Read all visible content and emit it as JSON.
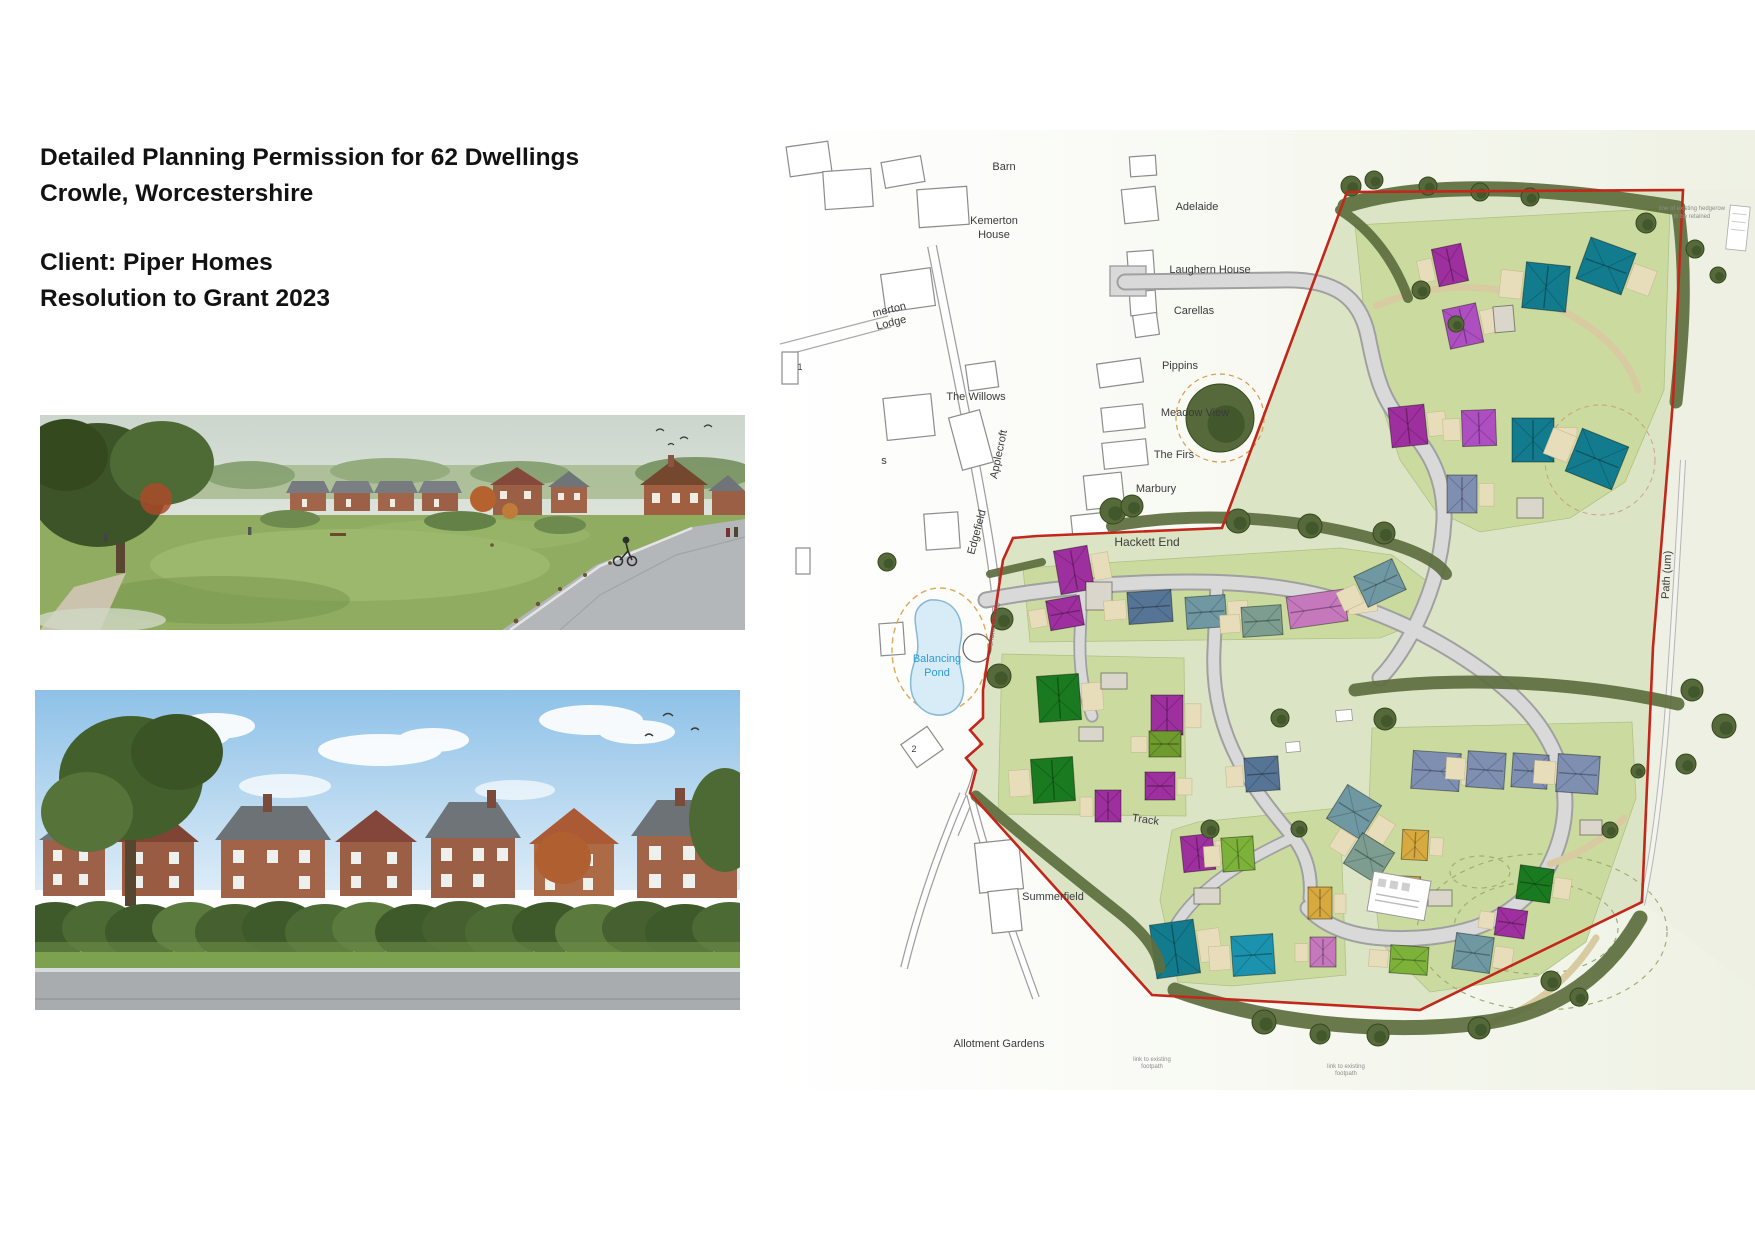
{
  "header": {
    "line1": "Detailed Planning Permission for 62 Dwellings",
    "line2": "Crowle, Worcestershire",
    "line3": "Client: Piper Homes",
    "line4": "Resolution to Grant 2023"
  },
  "map": {
    "boundary_color": "#c2271b",
    "pond_text_color": "#2e9bd6",
    "palette": {
      "magenta": "#9e2f9e",
      "violet": "#ad4fc0",
      "pink": "#c678bd",
      "teal": "#127c8e",
      "cyan": "#1b93ae",
      "steel": "#7e8fb2",
      "bluegrey": "#567495",
      "tealgrey": "#6f98a3",
      "sage": "#7d9d90",
      "green": "#1a7a1f",
      "lime": "#7cb23a",
      "olive": "#6f9a2e",
      "yellow": "#d8a93e",
      "garage": "#dad6cc"
    },
    "labels": [
      {
        "t": "Barn",
        "x": 224,
        "y": 40
      },
      {
        "t": "Kemerton",
        "x": 214,
        "y": 94
      },
      {
        "t": "House",
        "x": 214,
        "y": 108
      },
      {
        "t": "merton",
        "x": 110,
        "y": 183,
        "r": -14
      },
      {
        "t": "Lodge",
        "x": 112,
        "y": 196,
        "r": -14
      },
      {
        "t": "Adelaide",
        "x": 417,
        "y": 80
      },
      {
        "t": "Laughern House",
        "x": 430,
        "y": 143
      },
      {
        "t": "Carellas",
        "x": 414,
        "y": 184
      },
      {
        "t": "Pippins",
        "x": 400,
        "y": 239
      },
      {
        "t": "Meadow View",
        "x": 415,
        "y": 286
      },
      {
        "t": "The Firs",
        "x": 394,
        "y": 328
      },
      {
        "t": "Marbury",
        "x": 376,
        "y": 362
      },
      {
        "t": "The Willows",
        "x": 196,
        "y": 270
      },
      {
        "t": "Applecroft",
        "x": 222,
        "y": 325,
        "r": -78
      },
      {
        "t": "Edgefield",
        "x": 200,
        "y": 403,
        "r": -75
      },
      {
        "t": "s",
        "x": 104,
        "y": 334
      },
      {
        "t": "Hackett End",
        "x": 367,
        "y": 416,
        "s": 12
      },
      {
        "t": "Balancing",
        "x": 157,
        "y": 532,
        "c": "#2e9bd6"
      },
      {
        "t": "Pond",
        "x": 157,
        "y": 546,
        "c": "#2e9bd6"
      },
      {
        "t": "Summerfield",
        "x": 273,
        "y": 770
      },
      {
        "t": "Allotment Gardens",
        "x": 219,
        "y": 917
      },
      {
        "t": "Track",
        "x": 365,
        "y": 693,
        "r": 8
      },
      {
        "t": "Path (um)",
        "x": 890,
        "y": 445,
        "r": -87
      },
      {
        "t": "CHURCH ROAD",
        "x": 216,
        "y": 495,
        "r": -80,
        "s": 6,
        "c": "#666666"
      },
      {
        "t": "2",
        "x": 134,
        "y": 622,
        "s": 9
      },
      {
        "t": "1",
        "x": 20,
        "y": 240,
        "s": 9
      },
      {
        "t": "line of existing hedgerow",
        "x": 912,
        "y": 80,
        "s": 6,
        "c": "#8d8d8d"
      },
      {
        "t": "to be retained",
        "x": 912,
        "y": 88,
        "s": 6,
        "c": "#8d8d8d"
      },
      {
        "t": "link to existing",
        "x": 372,
        "y": 931,
        "s": 6,
        "c": "#8d8d8d"
      },
      {
        "t": "footpath",
        "x": 372,
        "y": 938,
        "s": 6,
        "c": "#8d8d8d"
      },
      {
        "t": "link to existing",
        "x": 566,
        "y": 938,
        "s": 6,
        "c": "#8d8d8d"
      },
      {
        "t": "footpath",
        "x": 566,
        "y": 945,
        "s": 6,
        "c": "#8d8d8d"
      }
    ],
    "houses": [
      [
        655,
        116,
        30,
        38,
        -12,
        "magenta"
      ],
      [
        666,
        176,
        34,
        40,
        -12,
        "violet"
      ],
      [
        744,
        134,
        44,
        46,
        6,
        "teal"
      ],
      [
        802,
        114,
        48,
        44,
        20,
        "teal"
      ],
      [
        714,
        176,
        20,
        26,
        -5,
        "garage"
      ],
      [
        610,
        276,
        36,
        40,
        -6,
        "magenta"
      ],
      [
        682,
        280,
        34,
        36,
        -2,
        "violet"
      ],
      [
        732,
        288,
        42,
        44,
        0,
        "teal"
      ],
      [
        792,
        306,
        50,
        46,
        22,
        "teal"
      ],
      [
        667,
        345,
        30,
        38,
        0,
        "steel"
      ],
      [
        737,
        368,
        26,
        20,
        0,
        "garage"
      ],
      [
        277,
        418,
        34,
        44,
        -10,
        "magenta"
      ],
      [
        268,
        468,
        34,
        30,
        -10,
        "magenta"
      ],
      [
        306,
        452,
        26,
        28,
        0,
        "garage"
      ],
      [
        348,
        461,
        44,
        32,
        -4,
        "bluegrey"
      ],
      [
        406,
        466,
        40,
        32,
        -4,
        "tealgrey"
      ],
      [
        462,
        476,
        40,
        30,
        -4,
        "sage"
      ],
      [
        508,
        463,
        58,
        32,
        -8,
        "pink"
      ],
      [
        579,
        436,
        42,
        34,
        -25,
        "tealgrey"
      ],
      [
        258,
        545,
        42,
        46,
        -4,
        "green"
      ],
      [
        252,
        628,
        42,
        44,
        -4,
        "green"
      ],
      [
        371,
        565,
        32,
        40,
        0,
        "magenta"
      ],
      [
        369,
        601,
        32,
        26,
        0,
        "olive"
      ],
      [
        365,
        642,
        30,
        28,
        0,
        "magenta"
      ],
      [
        315,
        660,
        26,
        32,
        0,
        "magenta"
      ],
      [
        321,
        543,
        26,
        16,
        0,
        "garage"
      ],
      [
        299,
        597,
        24,
        14,
        0,
        "garage"
      ],
      [
        402,
        705,
        32,
        36,
        -6,
        "magenta"
      ],
      [
        442,
        707,
        32,
        34,
        -4,
        "lime"
      ],
      [
        373,
        792,
        44,
        54,
        -8,
        "teal"
      ],
      [
        452,
        805,
        42,
        40,
        -4,
        "cyan"
      ],
      [
        528,
        757,
        24,
        32,
        0,
        "yellow"
      ],
      [
        530,
        807,
        26,
        30,
        0,
        "pink"
      ],
      [
        414,
        758,
        26,
        16,
        0,
        "garage"
      ],
      [
        465,
        627,
        34,
        34,
        -4,
        "bluegrey"
      ],
      [
        554,
        662,
        40,
        40,
        32,
        "tealgrey"
      ],
      [
        570,
        710,
        38,
        36,
        32,
        "sage"
      ],
      [
        622,
        700,
        26,
        30,
        3,
        "yellow"
      ],
      [
        608,
        746,
        32,
        28,
        3,
        "yellow"
      ],
      [
        632,
        622,
        48,
        38,
        4,
        "steel"
      ],
      [
        687,
        622,
        38,
        36,
        4,
        "steel"
      ],
      [
        732,
        624,
        36,
        34,
        4,
        "steel"
      ],
      [
        777,
        625,
        42,
        38,
        4,
        "steel"
      ],
      [
        738,
        737,
        34,
        34,
        8,
        "green"
      ],
      [
        716,
        779,
        30,
        28,
        8,
        "magenta"
      ],
      [
        674,
        805,
        38,
        36,
        8,
        "tealgrey"
      ],
      [
        610,
        816,
        38,
        28,
        4,
        "lime"
      ],
      [
        648,
        760,
        24,
        16,
        0,
        "garage"
      ],
      [
        800,
        690,
        22,
        15,
        0,
        "garage"
      ]
    ],
    "trees": [
      [
        440,
        288,
        34
      ],
      [
        333,
        381,
        13
      ],
      [
        352,
        376,
        11
      ],
      [
        458,
        391,
        12
      ],
      [
        530,
        396,
        12
      ],
      [
        604,
        403,
        11
      ],
      [
        571,
        56,
        10
      ],
      [
        594,
        50,
        9
      ],
      [
        648,
        56,
        9
      ],
      [
        700,
        62,
        9
      ],
      [
        750,
        67,
        9
      ],
      [
        866,
        93,
        10
      ],
      [
        915,
        119,
        9
      ],
      [
        938,
        145,
        8
      ],
      [
        641,
        160,
        9
      ],
      [
        676,
        194,
        8
      ],
      [
        912,
        560,
        11
      ],
      [
        944,
        596,
        12
      ],
      [
        906,
        634,
        10
      ],
      [
        500,
        588,
        9
      ],
      [
        605,
        589,
        11
      ],
      [
        430,
        699,
        9
      ],
      [
        519,
        699,
        8
      ],
      [
        484,
        892,
        12
      ],
      [
        540,
        904,
        10
      ],
      [
        598,
        905,
        11
      ],
      [
        699,
        898,
        11
      ],
      [
        771,
        851,
        10
      ],
      [
        799,
        867,
        9
      ],
      [
        640,
        769,
        8
      ],
      [
        830,
        700,
        8
      ],
      [
        858,
        641,
        7
      ],
      [
        222,
        489,
        11
      ],
      [
        219,
        546,
        12
      ],
      [
        107,
        432,
        9
      ]
    ]
  }
}
